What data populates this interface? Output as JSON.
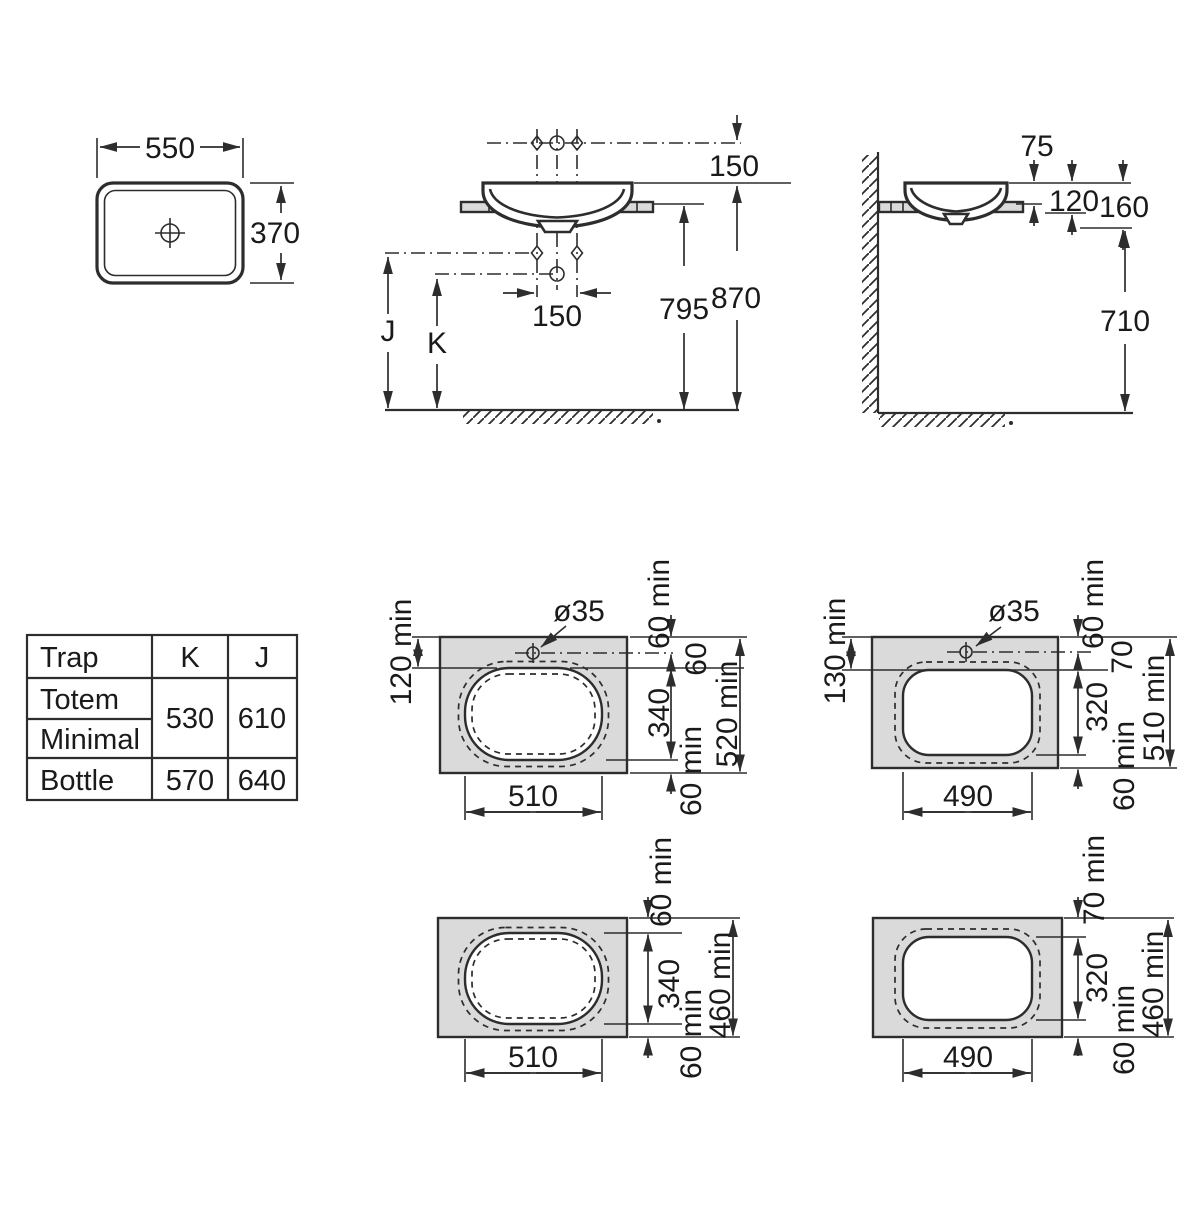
{
  "colors": {
    "line": "#2d2d2d",
    "counter_fill": "#dadada",
    "text": "#1a1a1a",
    "background": "#ffffff"
  },
  "plan_view": {
    "width_dim": "550",
    "depth_dim": "370"
  },
  "front_view": {
    "tap_height_dim": "150",
    "tap_spacing_dim": "150",
    "counter_height_dim": "795",
    "rim_height_dim": "870",
    "trap_j_label": "J",
    "trap_k_label": "K"
  },
  "side_view": {
    "rim_above_counter_dim": "75",
    "rim_to_counter_bottom_dim": "120",
    "rim_to_basin_bottom_dim": "160",
    "clearance_height_dim": "710"
  },
  "trap_table": {
    "header_trap": "Trap",
    "header_k": "K",
    "header_j": "J",
    "row_totem": "Totem",
    "row_minimal": "Minimal",
    "row_bottle": "Bottle",
    "totem_minimal_k": "530",
    "totem_minimal_j": "610",
    "bottle_k": "570",
    "bottle_j": "640"
  },
  "cutouts": {
    "oval_tap": {
      "tap_hole_dia": "ø35",
      "left_dim": "120 min",
      "edge_to_tap_dim": "60 min",
      "tap_to_cutout_dim": "60",
      "depth_dim": "340",
      "bottom_margin_dim": "60 min",
      "overall_dim": "520 min",
      "width_dim": "510"
    },
    "rect_tap": {
      "tap_hole_dia": "ø35",
      "left_dim": "130 min",
      "edge_to_tap_dim": "60 min",
      "tap_to_cutout_dim": "70",
      "depth_dim": "320",
      "bottom_margin_dim": "60 min",
      "overall_dim": "510 min",
      "width_dim": "490"
    },
    "oval_plain": {
      "top_margin_dim": "60 min",
      "depth_dim": "340",
      "bottom_margin_dim": "60 min",
      "overall_dim": "460 min",
      "width_dim": "510"
    },
    "rect_plain": {
      "top_margin_dim": "70 min",
      "depth_dim": "320",
      "bottom_margin_dim": "60 min",
      "overall_dim": "460 min",
      "width_dim": "490"
    }
  }
}
